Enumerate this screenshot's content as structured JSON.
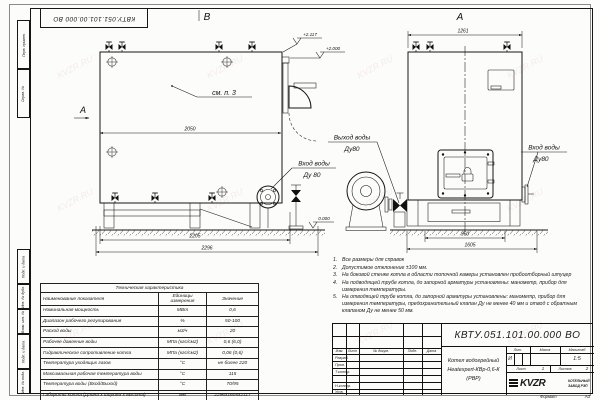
{
  "watermark": "KVZR.RU",
  "corner_stamp": "КВТУ.051.101.00.000 ВО",
  "margin_labels": [
    "Перв. примен.",
    "Справ. №",
    "Подп. и дата",
    "Инв. № дубл.",
    "Взам. инв. №",
    "Подп. и дата",
    "Инв. № подл."
  ],
  "views": {
    "b": {
      "label": "В",
      "direction_marker": "А",
      "see_note": "см. п. 3",
      "elev_top": "+2.117",
      "elev_mid": "+2.000",
      "elev_ground": "0.000",
      "dim_top": "2050",
      "dim_bottom_inner": "2205",
      "dim_bottom_outer": "2296",
      "inlet_line1": "Вход воды",
      "inlet_line2": "Ду 80"
    },
    "a": {
      "label": "А",
      "dim_top": "1261",
      "dim_bottom_inner": "960",
      "dim_bottom_outer": "1605",
      "outlet_line1": "Выход воды",
      "outlet_line2": "Ду80",
      "inlet_line1": "Вход воды",
      "inlet_line2": "Ду80"
    }
  },
  "notes": [
    {
      "n": "1.",
      "text": "Все размеры для справок"
    },
    {
      "n": "2.",
      "text": "Допустимое отклонение ±100 мм."
    },
    {
      "n": "3.",
      "text": "На боковой стенке котла в области топочной камеры установлен пробоотборный штуцер"
    },
    {
      "n": "4.",
      "text": "На подводящей трубе котла, до запорной арматуры установлены: манометр, прибор для измерения температуры."
    },
    {
      "n": "5.",
      "text": "На отводящей трубе котла, до запорной арматуры установлены: манометр, прибор для измерения температуры, предохранительный клапан Ду не менее 40 мм и отвод с обратным клапаном Ду не менее 50 мм."
    }
  ],
  "tech_table": {
    "title": "Техническая характеристика",
    "col_name": "Наименование показателя",
    "col_unit": "Единицы измерения",
    "col_value": "Значение",
    "rows": [
      {
        "name": "Номинальная мощность",
        "unit": "МВт",
        "value": "0,6"
      },
      {
        "name": "Диапазон рабочего регулирования",
        "unit": "%",
        "value": "50-100"
      },
      {
        "name": "Расход воды",
        "unit": "м3/ч",
        "value": "20"
      },
      {
        "name": "Рабочее давление воды",
        "unit": "МПа (кгс/см2)",
        "value": "0,6 (6,0)"
      },
      {
        "name": "Гидравлическое сопротивление котла",
        "unit": "МПа (кгс/см2)",
        "value": "0,06 (0,6)"
      },
      {
        "name": "Температура уходящих газов",
        "unit": "°С",
        "value": "не более 220"
      },
      {
        "name": "Максимальная рабочая температура воды",
        "unit": "°С",
        "value": "115"
      },
      {
        "name": "Температура воды (Вход/Выход)",
        "unit": "°С",
        "value": "70/95"
      },
      {
        "name": "Габариты котла (Длина х ширина х высота)",
        "unit": "мм",
        "value": "2296х1605х2117"
      }
    ]
  },
  "title_block": {
    "doc_number": "КВТУ.051.101.00.000 ВО",
    "col_izm": "Изм.",
    "col_list": "Лист",
    "col_doc": "№ докум.",
    "col_podp": "Подп.",
    "col_data": "Дата",
    "row_razrab": "Разраб.",
    "row_prov": "Пров.",
    "row_tkontr": "Т.контр.",
    "row_nkontr": "Н.контр.",
    "row_utv": "Утв.",
    "product_line1": "Котел водогрейный",
    "product_line2": "Heatexpert-КВр-0,6-К (РВР)",
    "lit_label": "Лит.",
    "mass_label": "Масса",
    "scale_label": "Масштаб",
    "lit_value": "И",
    "scale_value": "1:5",
    "sheet_label": "Лист",
    "sheet_value": "1",
    "sheets_label": "Листов",
    "sheets_value": "2",
    "logo": "KVZR",
    "logo_sub1": "КОТЕЛЬНЫЙ",
    "logo_sub2": "ЗАВОД РЭП",
    "format_label": "Формат",
    "format_value": "А3"
  }
}
